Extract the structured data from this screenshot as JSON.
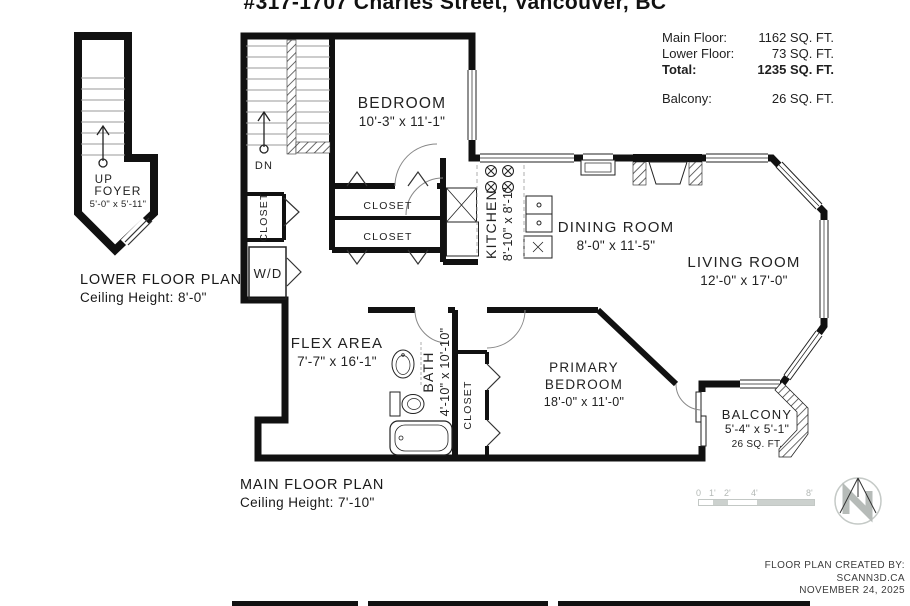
{
  "title": "#317-1707 Charles Street, Vancouver, BC",
  "area_summary": {
    "rows": [
      {
        "label": "Main Floor:",
        "value": "1162 SQ. FT."
      },
      {
        "label": "Lower Floor:",
        "value": "73 SQ. FT."
      },
      {
        "label": "Total:",
        "value": "1235 SQ. FT."
      },
      {
        "label": "Balcony:",
        "value": "26 SQ. FT."
      }
    ]
  },
  "lower_floor": {
    "caption": "LOWER FLOOR PLAN",
    "ceiling": "Ceiling Height: 8'-0\"",
    "stair_direction": "UP",
    "foyer": {
      "name": "FOYER",
      "dims": "5'-0\" x 5'-11\""
    }
  },
  "main_floor": {
    "caption": "MAIN FLOOR PLAN",
    "ceiling": "Ceiling Height: 7'-10\"",
    "stair_direction": "DN",
    "rooms": {
      "bedroom": {
        "name": "BEDROOM",
        "dims": "10'-3\" x 11'-1\""
      },
      "kitchen": {
        "name": "KITCHEN",
        "dims": "8'-10\" x 8'-1\""
      },
      "dining_room": {
        "name": "DINING ROOM",
        "dims": "8'-0\" x 11'-5\""
      },
      "living_room": {
        "name": "LIVING ROOM",
        "dims": "12'-0\" x 17'-0\""
      },
      "flex_area": {
        "name": "FLEX AREA",
        "dims": "7'-7\" x 16'-1\""
      },
      "bath": {
        "name": "BATH",
        "dims": "4'-10\" x 10'-10\""
      },
      "primary_bedroom": {
        "name_line1": "PRIMARY",
        "name_line2": "BEDROOM",
        "dims": "18'-0\" x 11'-0\""
      },
      "balcony": {
        "name": "BALCONY",
        "dims": "5'-4\" x 5'-1\"",
        "area": "26 SQ. FT."
      }
    },
    "labels": {
      "closet": "CLOSET",
      "washer_dryer": "W/D"
    }
  },
  "scale_bar": {
    "ticks": [
      "0",
      "1'",
      "2'",
      "4'",
      "8'"
    ]
  },
  "credit": {
    "line1": "FLOOR PLAN CREATED BY:",
    "line2": "SCANN3D.CA",
    "line3": "NOVEMBER 24, 2025"
  },
  "colors": {
    "wall": "#111111",
    "text": "#1f1f1f",
    "muted": "#b7bcb9",
    "scale_gray": "#ccd1ce"
  }
}
